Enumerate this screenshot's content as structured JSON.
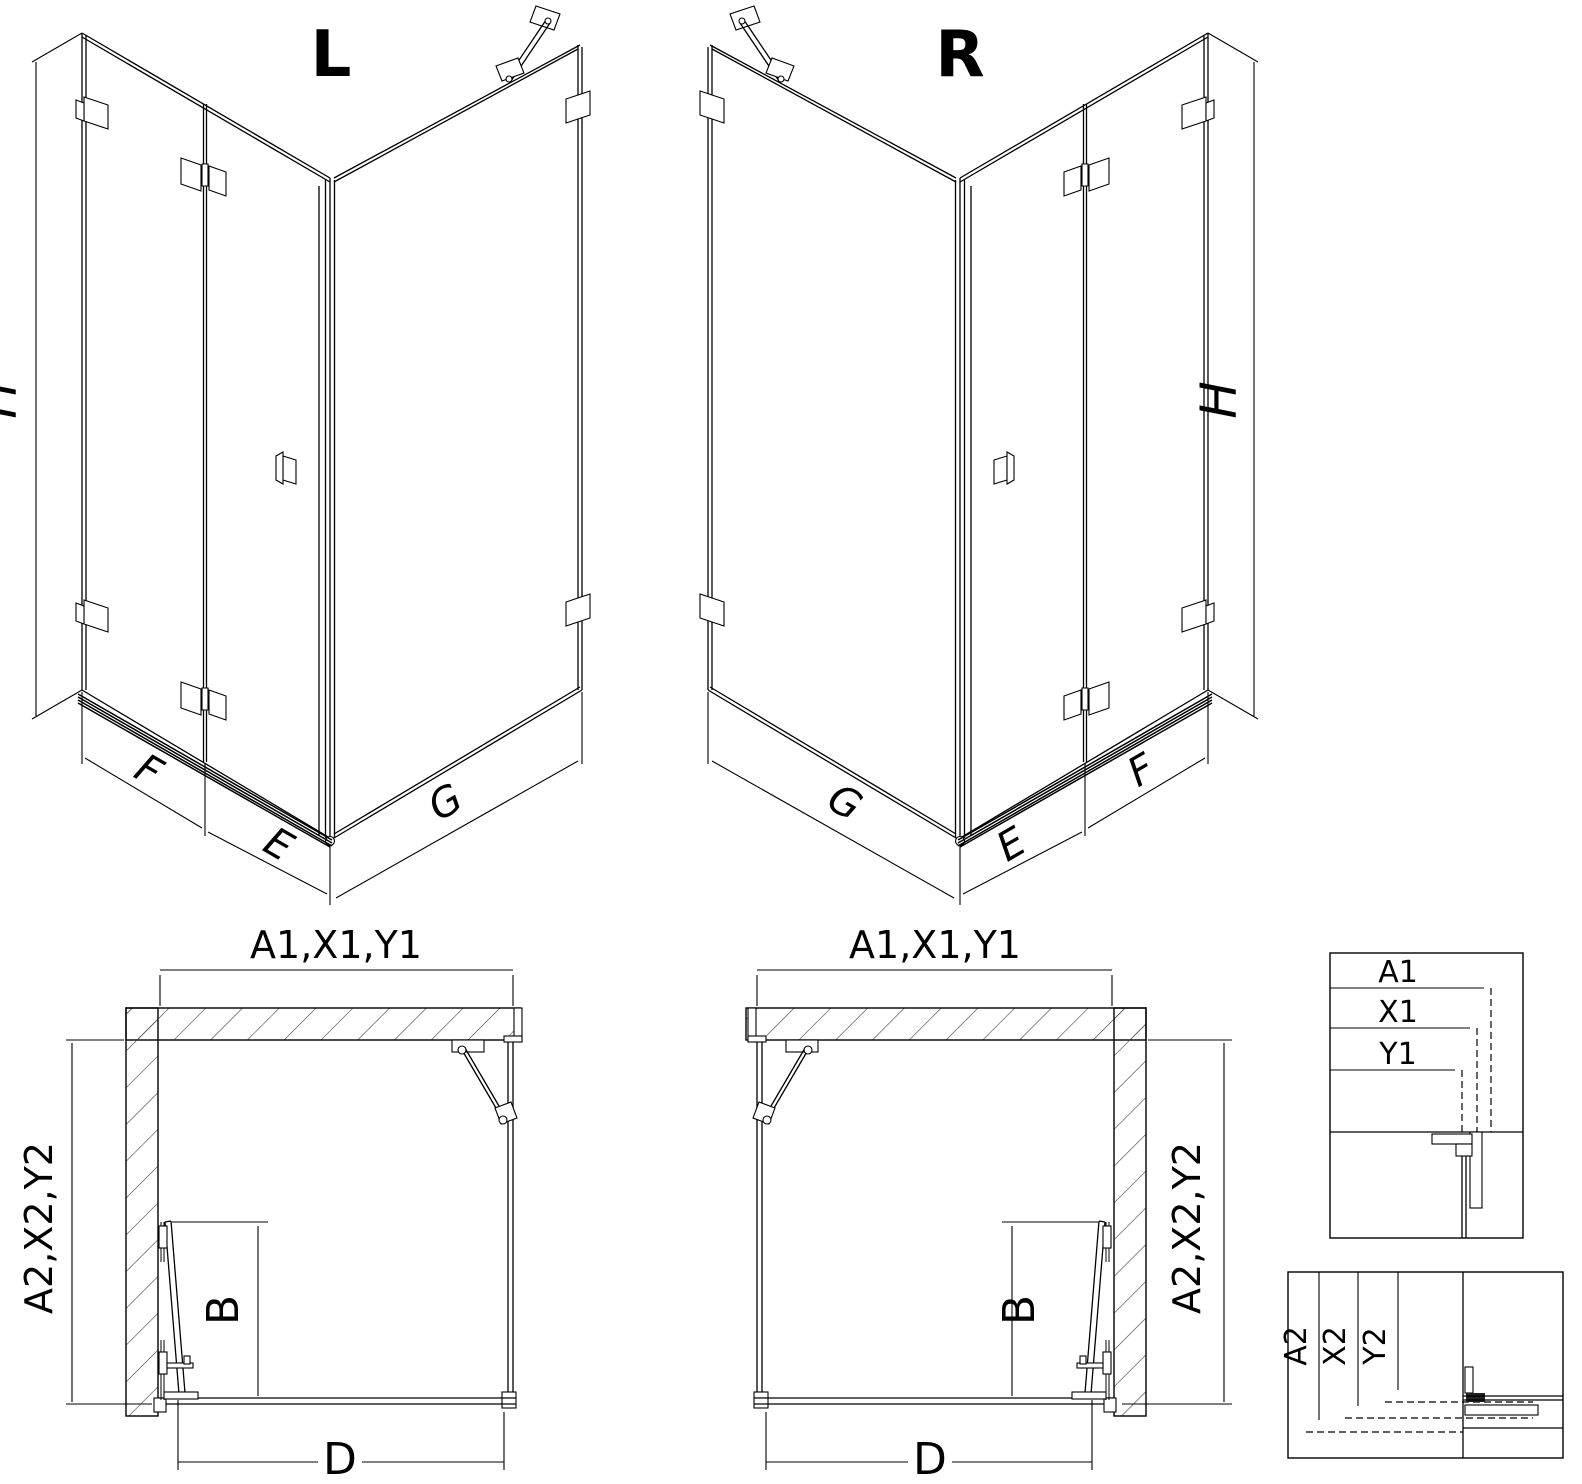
{
  "drawing": {
    "iso_left": {
      "label": "L",
      "height_dim": "H",
      "panel_dims": {
        "f": "F",
        "e": "E",
        "g": "G"
      }
    },
    "iso_right": {
      "label": "R",
      "height_dim": "H",
      "panel_dims": {
        "f": "F",
        "e": "E",
        "g": "G"
      }
    },
    "plan_left": {
      "top_dim": "A1,X1,Y1",
      "side_dim": "A2,X2,Y2",
      "door_dim": "B",
      "bottom_dim": "D"
    },
    "plan_right": {
      "top_dim": "A1,X1,Y1",
      "side_dim": "A2,X2,Y2",
      "door_dim": "B",
      "bottom_dim": "D"
    },
    "detail_width": {
      "dims": [
        "A1",
        "X1",
        "Y1"
      ]
    },
    "detail_depth": {
      "dims": [
        "A2",
        "X2",
        "Y2"
      ]
    }
  },
  "colors": {
    "line": "#000000",
    "hatch": "#404040",
    "background": "#ffffff"
  }
}
